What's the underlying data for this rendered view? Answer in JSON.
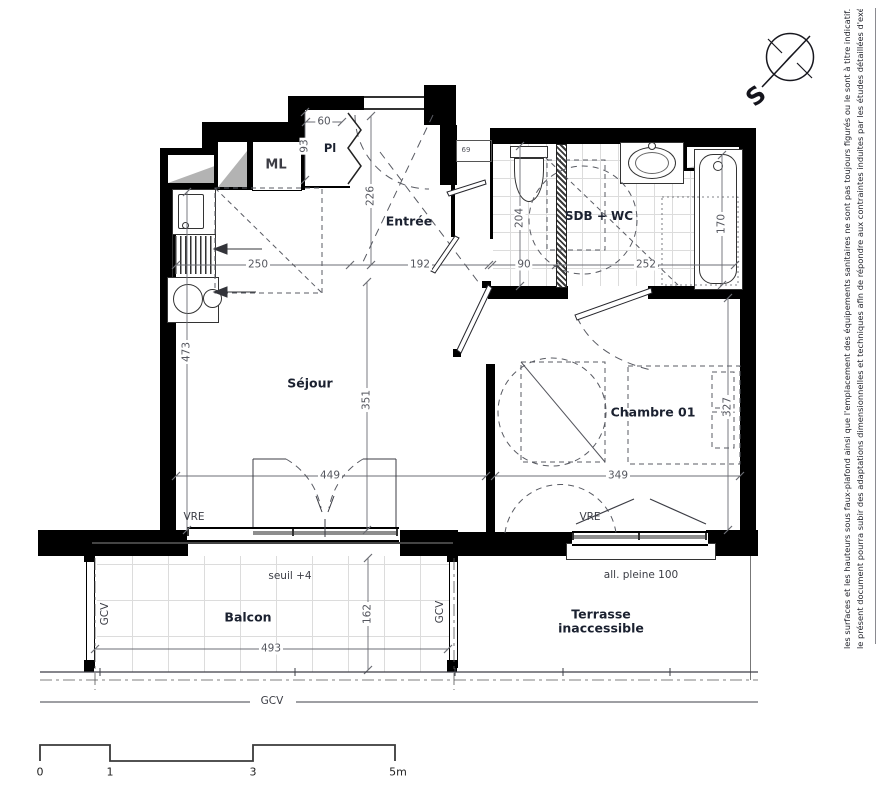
{
  "colors": {
    "wall": "#000000",
    "dimension_text": "#55575f",
    "room_label_text": "#1b2130",
    "tile_line": "#dcdcdc",
    "linework": "#3e3f47"
  },
  "compass": {
    "south_label": "S"
  },
  "rooms": {
    "sejour": "Séjour",
    "entree": "Entrée",
    "closet": "Pl",
    "washing_machine": "ML",
    "bathroom": "SDB + WC",
    "bedroom": "Chambre 01",
    "balcony": "Balcon",
    "terrace_line1": "Terrasse",
    "terrace_line2": "inaccessible"
  },
  "dimensions_cm": {
    "kitchen_width": "250",
    "entry_width": "192",
    "entry_depth": "226",
    "closet_depth": "93",
    "closet_width": "60",
    "bathroom_depth": "204",
    "wc_zone_width": "90",
    "bathroom_width": "252",
    "bathtub_length": "170",
    "living_total_depth": "473",
    "living_inner_depth": "351",
    "living_width": "449",
    "bedroom_width": "349",
    "bedroom_depth": "327",
    "balcony_depth": "162",
    "balcony_width": "493",
    "entry_door_width": "69"
  },
  "annotations": {
    "window_left": "VRE",
    "window_right": "VRE",
    "rail_left": "GCV",
    "rail_right": "GCV",
    "rail_bottom": "GCV",
    "threshold": "seuil +4",
    "sill": "all. pleine 100"
  },
  "scale_bar": {
    "labels": [
      "0",
      "1",
      "3",
      "5m"
    ]
  },
  "disclaimer": {
    "line1": "le présent document pourra subir des adaptations dimensionnelles et techniques afin de répondre aux contraintes induites par les études détaillées d'exécution",
    "line2": "les surfaces et les hauteurs sous faux-plafond ainsi que l'emplacement des équipements sanitaires ne sont pas toujours figurés ou le sont à titre indicatif."
  }
}
